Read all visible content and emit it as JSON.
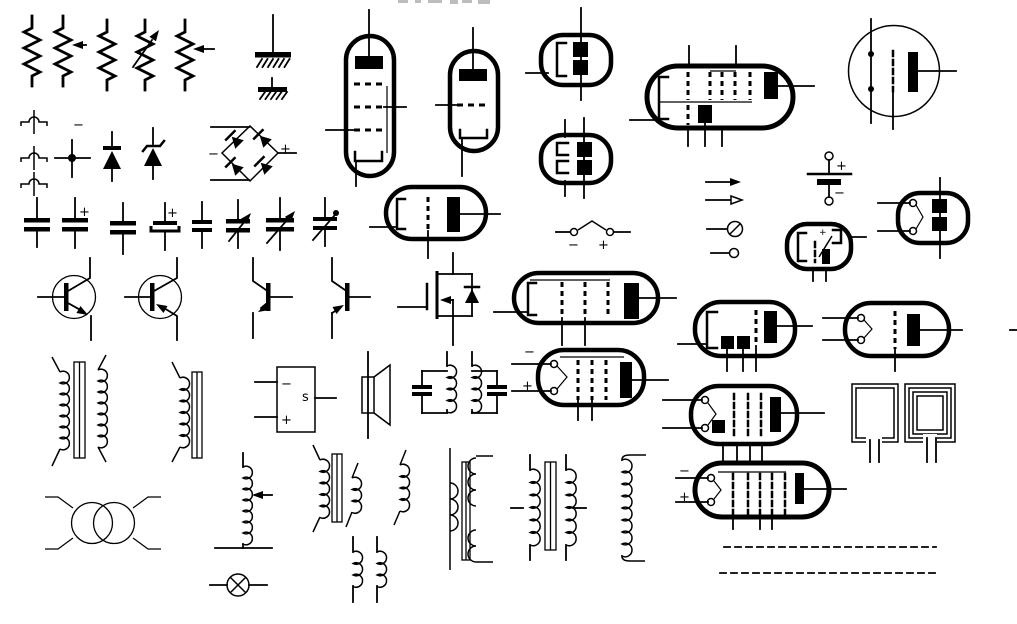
{
  "canvas": {
    "width": 1017,
    "height": 624,
    "background": "#ffffff",
    "ink": "#000000"
  },
  "glyphs": {
    "plus": "+",
    "minus": "−",
    "s_label": "s"
  },
  "sheet": {
    "description": "Library sheet of electronic schematic symbols",
    "symbols": [
      {
        "name": "fixed-resistor-1",
        "x": 32,
        "y": 50
      },
      {
        "name": "potentiometer",
        "x": 63,
        "y": 50
      },
      {
        "name": "fixed-resistor-2",
        "x": 107,
        "y": 55
      },
      {
        "name": "variable-resistor",
        "x": 145,
        "y": 55
      },
      {
        "name": "rheostat",
        "x": 185,
        "y": 55
      },
      {
        "name": "earth-ground",
        "x": 273,
        "y": 40
      },
      {
        "name": "chassis-ground",
        "x": 272,
        "y": 90
      },
      {
        "name": "wire-jump-1",
        "x": 34,
        "y": 122
      },
      {
        "name": "wire-jump-2",
        "x": 34,
        "y": 158
      },
      {
        "name": "wire-jump-3",
        "x": 34,
        "y": 184
      },
      {
        "name": "minus-mark",
        "x": 78,
        "y": 125
      },
      {
        "name": "wire-junction-dot",
        "x": 72,
        "y": 158
      },
      {
        "name": "diode",
        "x": 112,
        "y": 156
      },
      {
        "name": "zener-diode",
        "x": 153,
        "y": 155
      },
      {
        "name": "bridge-rectifier",
        "x": 250,
        "y": 153
      },
      {
        "name": "capacitor-fixed-1",
        "x": 37,
        "y": 225
      },
      {
        "name": "capacitor-polarized",
        "x": 75,
        "y": 225
      },
      {
        "name": "capacitor-fixed-2",
        "x": 123,
        "y": 227
      },
      {
        "name": "capacitor-electrolytic",
        "x": 165,
        "y": 227
      },
      {
        "name": "capacitor-fixed-small",
        "x": 202,
        "y": 226
      },
      {
        "name": "capacitor-variable-1",
        "x": 238,
        "y": 225
      },
      {
        "name": "capacitor-variable-2",
        "x": 280,
        "y": 224
      },
      {
        "name": "capacitor-trimmer",
        "x": 325,
        "y": 222
      },
      {
        "name": "npn-transistor-circled",
        "x": 74,
        "y": 297
      },
      {
        "name": "pnp-transistor-circled",
        "x": 160,
        "y": 297
      },
      {
        "name": "npn-transistor",
        "x": 270,
        "y": 297
      },
      {
        "name": "pnp-transistor",
        "x": 348,
        "y": 297
      },
      {
        "name": "mosfet-with-body-diode",
        "x": 440,
        "y": 297
      },
      {
        "name": "pentode-tube-vertical",
        "x": 370,
        "y": 105
      },
      {
        "name": "triode-tube-vertical",
        "x": 473,
        "y": 100
      },
      {
        "name": "triode-tube-horizontal",
        "x": 436,
        "y": 213
      },
      {
        "name": "dual-diode-tube-1",
        "x": 576,
        "y": 60
      },
      {
        "name": "dual-diode-tube-2",
        "x": 576,
        "y": 159
      },
      {
        "name": "vibrator-contact",
        "x": 593,
        "y": 233
      },
      {
        "name": "pentagrid-converter-tube",
        "x": 719,
        "y": 97
      },
      {
        "name": "round-tube",
        "x": 894,
        "y": 71
      },
      {
        "name": "battery",
        "x": 829,
        "y": 180
      },
      {
        "name": "arrow-solid",
        "x": 723,
        "y": 182
      },
      {
        "name": "arrow-open",
        "x": 724,
        "y": 200
      },
      {
        "name": "crossed-circle-terminal",
        "x": 731,
        "y": 229
      },
      {
        "name": "circle-terminal",
        "x": 727,
        "y": 253
      },
      {
        "name": "tube-with-switch-contact",
        "x": 819,
        "y": 246
      },
      {
        "name": "full-wave-rectifier-tube",
        "x": 933,
        "y": 218
      },
      {
        "name": "pentode-tube-horizontal",
        "x": 586,
        "y": 298
      },
      {
        "name": "filament-triode-tube",
        "x": 590,
        "y": 377
      },
      {
        "name": "beam-power-tube",
        "x": 745,
        "y": 329
      },
      {
        "name": "filament-triode-tube-2",
        "x": 897,
        "y": 329
      },
      {
        "name": "multigrid-filament-tube",
        "x": 744,
        "y": 414
      },
      {
        "name": "filament-pentagrid-tube",
        "x": 762,
        "y": 490
      },
      {
        "name": "loop-antenna-single",
        "x": 875,
        "y": 414
      },
      {
        "name": "loop-antenna-multi",
        "x": 930,
        "y": 414
      },
      {
        "name": "opamp-block",
        "x": 296,
        "y": 399
      },
      {
        "name": "speaker",
        "x": 376,
        "y": 395
      },
      {
        "name": "double-tuned-lc-circuit",
        "x": 460,
        "y": 385
      },
      {
        "name": "iron-core-transformer",
        "x": 83,
        "y": 410
      },
      {
        "name": "choke-with-core",
        "x": 188,
        "y": 410
      },
      {
        "name": "air-core-transformer",
        "x": 103,
        "y": 523
      },
      {
        "name": "slider-tapped-coil",
        "x": 247,
        "y": 500
      },
      {
        "name": "indicator-lamp",
        "x": 238,
        "y": 585
      },
      {
        "name": "iron-core-transformer-2",
        "x": 338,
        "y": 488
      },
      {
        "name": "small-inductor",
        "x": 401,
        "y": 487
      },
      {
        "name": "inductor-pair",
        "x": 365,
        "y": 570
      },
      {
        "name": "rf-transformer-tapped",
        "x": 470,
        "y": 508
      },
      {
        "name": "center-tapped-transformer",
        "x": 550,
        "y": 507
      },
      {
        "name": "tall-solenoid-coil",
        "x": 628,
        "y": 506
      },
      {
        "name": "dashed-line-1",
        "x": 830,
        "y": 547
      },
      {
        "name": "dashed-line-2",
        "x": 827,
        "y": 573
      },
      {
        "name": "cropped-text-fragment",
        "x": 445,
        "y": 2
      }
    ],
    "dashed_lines": [
      {
        "x1": 724,
        "y": 547,
        "x2": 936
      },
      {
        "x1": 720,
        "y": 573,
        "x2": 935
      }
    ]
  }
}
